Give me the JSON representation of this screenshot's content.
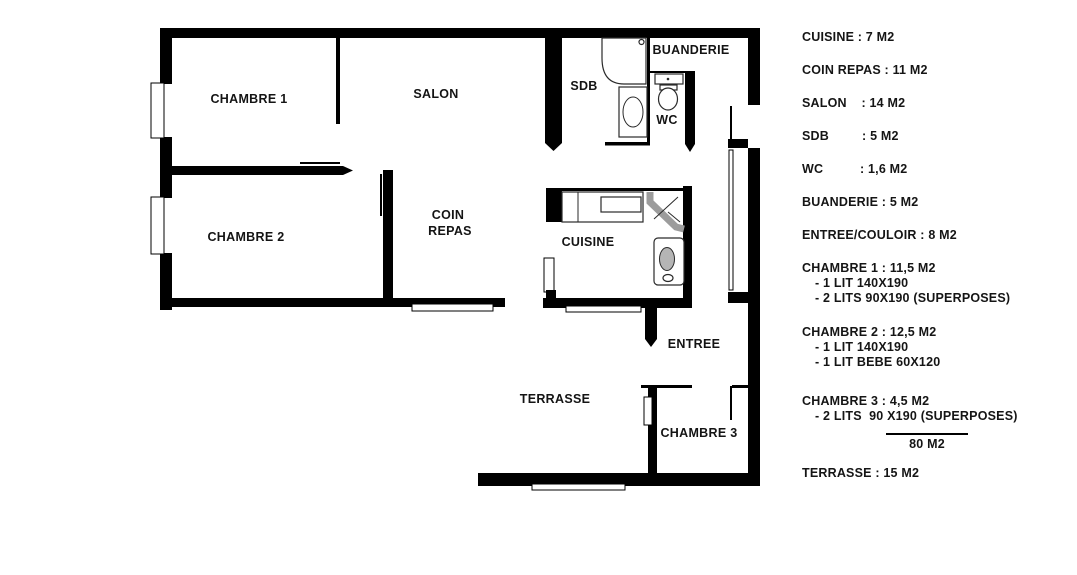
{
  "plan": {
    "rooms": {
      "chambre1": "CHAMBRE 1",
      "salon": "SALON",
      "sdb": "SDB",
      "buanderie": "BUANDERIE",
      "wc": "WC",
      "chambre2": "CHAMBRE 2",
      "coin1": "COIN",
      "coin2": "REPAS",
      "cuisine": "CUISINE",
      "entree": "ENTREE",
      "terrasse": "TERRASSE",
      "chambre3": "CHAMBRE 3"
    },
    "wall_color": "#000000",
    "fixture_gray": "#9c9c9c"
  },
  "legend": {
    "items": [
      {
        "label": "CUISINE : 7 M2"
      },
      {
        "label": "COIN REPAS : 11 M2"
      },
      {
        "label": "SALON    : 14 M2"
      },
      {
        "label": "SDB         : 5 M2"
      },
      {
        "label": "WC          : 1,6 M2"
      },
      {
        "label": "BUANDERIE : 5 M2"
      },
      {
        "label": "ENTREE/COULOIR : 8 M2"
      },
      {
        "label": "CHAMBRE 1 : 11,5 M2",
        "sub": [
          "- 1 LIT 140X190",
          "- 2 LITS 90X190 (SUPERPOSES)"
        ]
      },
      {
        "label": "CHAMBRE 2 : 12,5 M2",
        "sub": [
          "- 1 LIT 140X190",
          "- 1 LIT BEBE 60X120"
        ]
      },
      {
        "label": "CHAMBRE 3 : 4,5 M2",
        "sub": [
          "- 2 LITS  90 X190 (SUPERPOSES)"
        ]
      }
    ],
    "total": "80 M2",
    "terrace": "TERRASSE : 15 M2"
  }
}
